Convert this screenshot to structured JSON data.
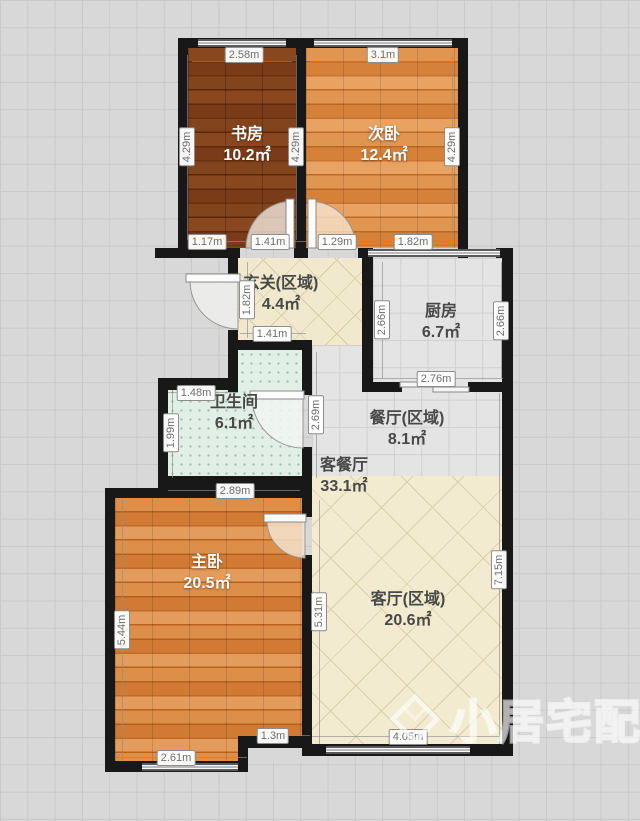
{
  "meta": {
    "type": "floor-plan",
    "language": "zh-CN",
    "unit": "m"
  },
  "colors": {
    "wall": "#181818",
    "background": "#d8d8d8",
    "study_floor": "#7d3f1a",
    "bedroom_floor": "#d8873f",
    "cream_tile": "#f2ebd0",
    "gray_tile": "#e4e4e4",
    "bathroom_tile": "#e1efe6"
  },
  "rooms": {
    "study": {
      "name": "书房",
      "area": "10.2㎡"
    },
    "second_bedroom": {
      "name": "次卧",
      "area": "12.4㎡"
    },
    "entry": {
      "name": "玄关(区域)",
      "area": "4.4㎡"
    },
    "kitchen": {
      "name": "厨房",
      "area": "6.7㎡"
    },
    "bathroom": {
      "name": "卫生间",
      "area": "6.1㎡"
    },
    "dining": {
      "name": "餐厅(区域)",
      "area": "8.1㎡"
    },
    "living_dining": {
      "name": "客餐厅",
      "area": "33.1㎡"
    },
    "master_bedroom": {
      "name": "主卧",
      "area": "20.5㎡"
    },
    "living": {
      "name": "客厅(区域)",
      "area": "20.6㎡"
    }
  },
  "dims": [
    {
      "id": "study-top-width",
      "label": "2.58m"
    },
    {
      "id": "bedroom2-top-width",
      "label": "3.1m"
    },
    {
      "id": "study-depth-left",
      "label": "4.29m"
    },
    {
      "id": "study-depth-right",
      "label": "4.29m"
    },
    {
      "id": "bedroom2-depth-right",
      "label": "4.29m"
    },
    {
      "id": "study-bottom-segment",
      "label": "1.17m"
    },
    {
      "id": "study-door-opening",
      "label": "1.41m"
    },
    {
      "id": "bedroom2-door-opening",
      "label": "1.29m"
    },
    {
      "id": "bedroom2-bottom-window",
      "label": "1.82m"
    },
    {
      "id": "entry-depth",
      "label": "1.82m"
    },
    {
      "id": "entry-bottom-width",
      "label": "1.41m"
    },
    {
      "id": "kitchen-depth-left",
      "label": "2.66m"
    },
    {
      "id": "kitchen-depth-right",
      "label": "2.66m"
    },
    {
      "id": "kitchen-width",
      "label": "2.76m"
    },
    {
      "id": "bathroom-top-segment",
      "label": "1.48m"
    },
    {
      "id": "bathroom-depth-left",
      "label": "1.99m"
    },
    {
      "id": "hallway-depth",
      "label": "2.69m"
    },
    {
      "id": "bathroom-width",
      "label": "2.89m"
    },
    {
      "id": "master-depth-left",
      "label": "5.44m"
    },
    {
      "id": "master-depth-right",
      "label": "5.31m"
    },
    {
      "id": "living-depth-right",
      "label": "7.15m"
    },
    {
      "id": "master-bottom-window",
      "label": "2.61m"
    },
    {
      "id": "master-bottom-segment",
      "label": "1.3m"
    },
    {
      "id": "living-bottom-width",
      "label": "4.05m"
    }
  ],
  "watermark": {
    "text": "小居宅配",
    "icon": "diamond-gem-logo"
  }
}
